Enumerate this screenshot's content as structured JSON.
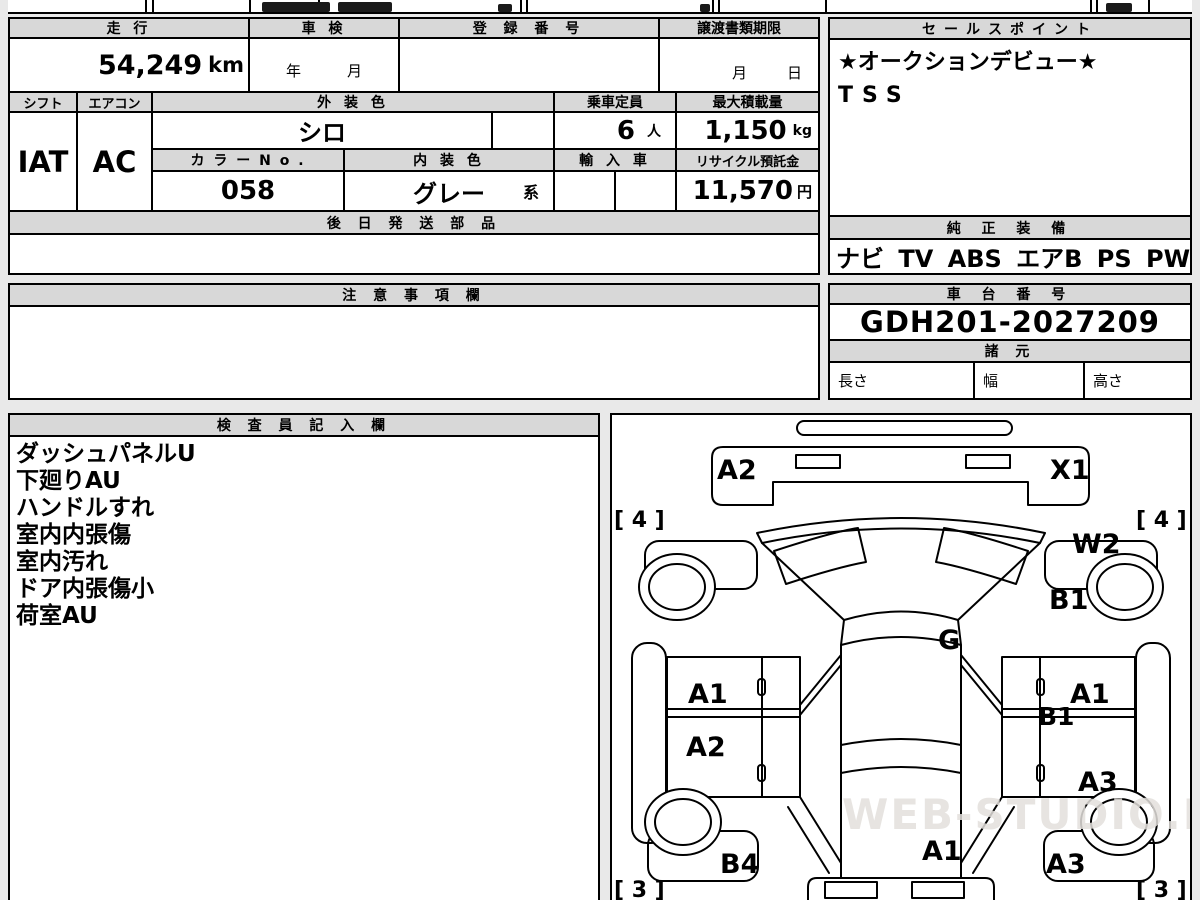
{
  "page": {
    "background": "#e9e9e9",
    "paper": "#ffffff",
    "header_fill": "#d8d8d8",
    "line_color": "#000000"
  },
  "vehicle_table": {
    "mileage": {
      "header": "走 行",
      "value": "54,249",
      "unit": "km"
    },
    "inspection": {
      "header": "車 検",
      "year_label": "年",
      "month_label": "月"
    },
    "registration": {
      "header": "登 録 番 号",
      "value": ""
    },
    "transfer_deadline": {
      "header": "譲渡書類期限",
      "month_label": "月",
      "day_label": "日"
    },
    "shift": {
      "header": "シフト",
      "value": "IAT"
    },
    "aircon": {
      "header": "エアコン",
      "value": "AC"
    },
    "exterior_color": {
      "header": "外 装 色",
      "value": "シロ"
    },
    "capacity": {
      "header": "乗車定員",
      "value": "6",
      "unit": "人"
    },
    "max_load": {
      "header": "最大積載量",
      "value": "1,150",
      "unit": "kg"
    },
    "color_no": {
      "header": "カ ラ ー N o .",
      "value": "058"
    },
    "interior_color": {
      "header": "内 装 色",
      "value": "グレー",
      "suffix": "系"
    },
    "import_car": {
      "header": "輸 入 車"
    },
    "recycle_deposit": {
      "header": "リサイクル預託金",
      "value": "11,570",
      "unit": "円"
    },
    "later_shipped_parts": {
      "header": "後 日 発 送 部 品",
      "value": ""
    }
  },
  "sales_points": {
    "header": "セールスポイント",
    "lines": [
      "★オークションデビュー★",
      "TSS"
    ]
  },
  "genuine_equipment": {
    "header": "純 正 装 備",
    "value": "ナビ TV ABS エアB PS PW"
  },
  "notes": {
    "header": "注 意 事 項 欄",
    "value": ""
  },
  "chassis_number": {
    "header": "車 台 番 号",
    "value": "GDH201-2027209"
  },
  "dimensions": {
    "header": "諸 元",
    "length_label": "長さ",
    "width_label": "幅",
    "height_label": "高さ"
  },
  "inspector_notes": {
    "header": "検 査 員 記 入 欄",
    "lines": [
      "ダッシュパネルU",
      "下廻りAU",
      "ハンドルすれ",
      "室内内張傷",
      "室内汚れ",
      "ドア内張傷小",
      "荷室AU"
    ]
  },
  "damage_diagram": {
    "watermark": "WEB-STUDIO.RU",
    "labels": {
      "front_bumper_left": "A2",
      "front_bumper_right": "X1",
      "tire_front_left": "[ 4 ]",
      "tire_front_right": "[ 4 ]",
      "front_fender_right": "W2",
      "pillar_right": "B1",
      "cowl": "G",
      "front_door_left": "A1",
      "slide_door_left": "A2",
      "front_door_right": "A1",
      "molding_right": "B1",
      "rear_door_right": "A3",
      "quarter_left": "B4",
      "rear_panel": "A1",
      "rear_quarter_right": "A3",
      "tire_rear_left": "[ 3 ]",
      "tire_rear_right": "[ 3 ]"
    }
  }
}
